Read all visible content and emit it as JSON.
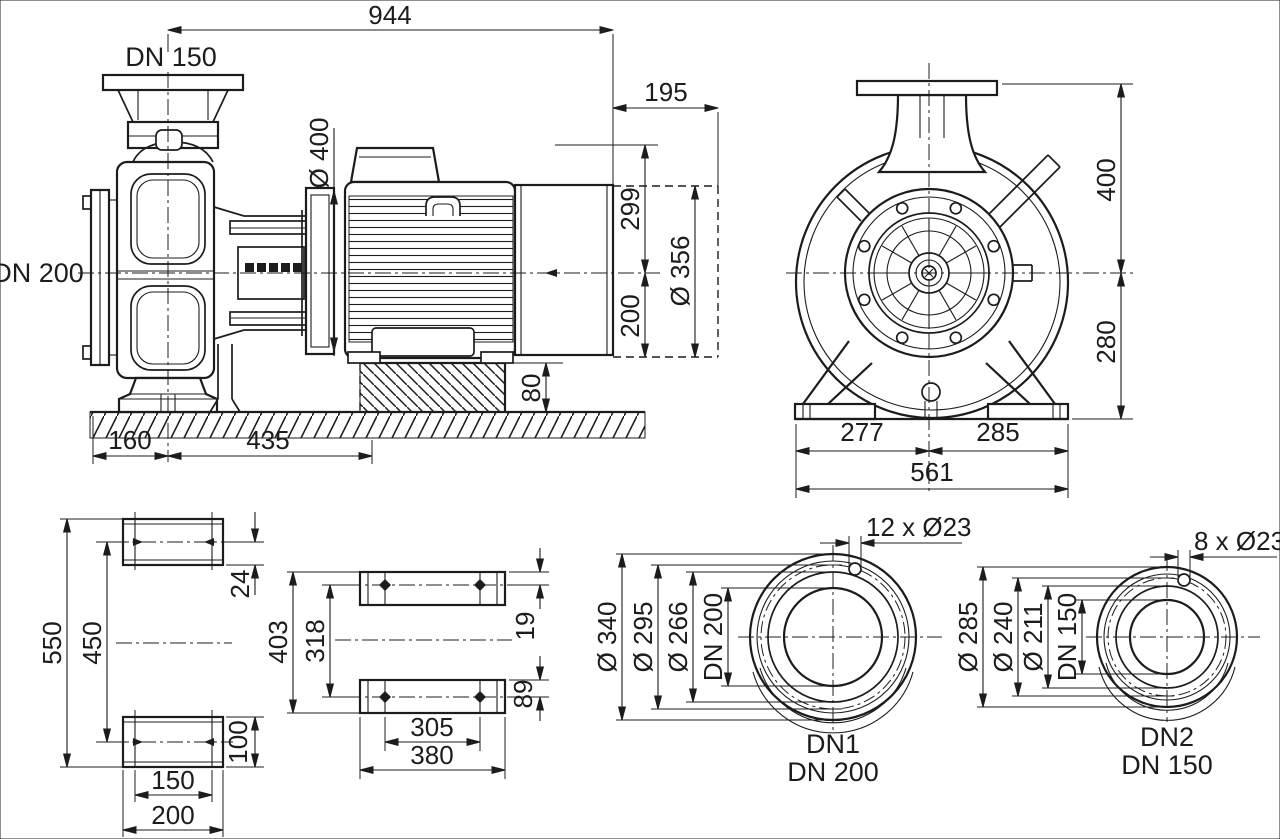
{
  "colors": {
    "ink": "#1c1c1c",
    "background": "#ffffff"
  },
  "side_view": {
    "discharge_label": "DN 150",
    "suction_label": "DN 200",
    "dims": {
      "overall": "944",
      "motor_ext": "195",
      "motor_dia": "Ø 400",
      "above_axis": "299",
      "below_axis": "200",
      "fan_dia": "Ø 356",
      "foundation_h": "80",
      "suction_to_axis": "160",
      "axis_to_found": "435"
    }
  },
  "end_view": {
    "dims": {
      "top": "400",
      "bottom": "280",
      "left": "277",
      "right": "285",
      "base": "561"
    }
  },
  "pump_foot_plan": {
    "dims": {
      "overall": "550",
      "holes": "450",
      "edge": "24",
      "plate": "100",
      "holes_w": "150",
      "plate_w": "200"
    }
  },
  "motor_foot_plan": {
    "dims": {
      "overall": "403",
      "holes": "318",
      "front": "19",
      "rear": "89",
      "holes_w": "305",
      "plate_w": "380"
    }
  },
  "dn1": {
    "bolts": "12 x Ø23",
    "outer": "Ø 340",
    "bolt_circle": "Ø 295",
    "face": "Ø 266",
    "bore": "DN 200",
    "name": "DN1",
    "size": "DN 200"
  },
  "dn2": {
    "bolts": "8 x Ø23",
    "outer": "Ø 285",
    "bolt_circle": "Ø 240",
    "face": "Ø 211",
    "bore": "DN 150",
    "name": "DN2",
    "size": "DN 150"
  }
}
